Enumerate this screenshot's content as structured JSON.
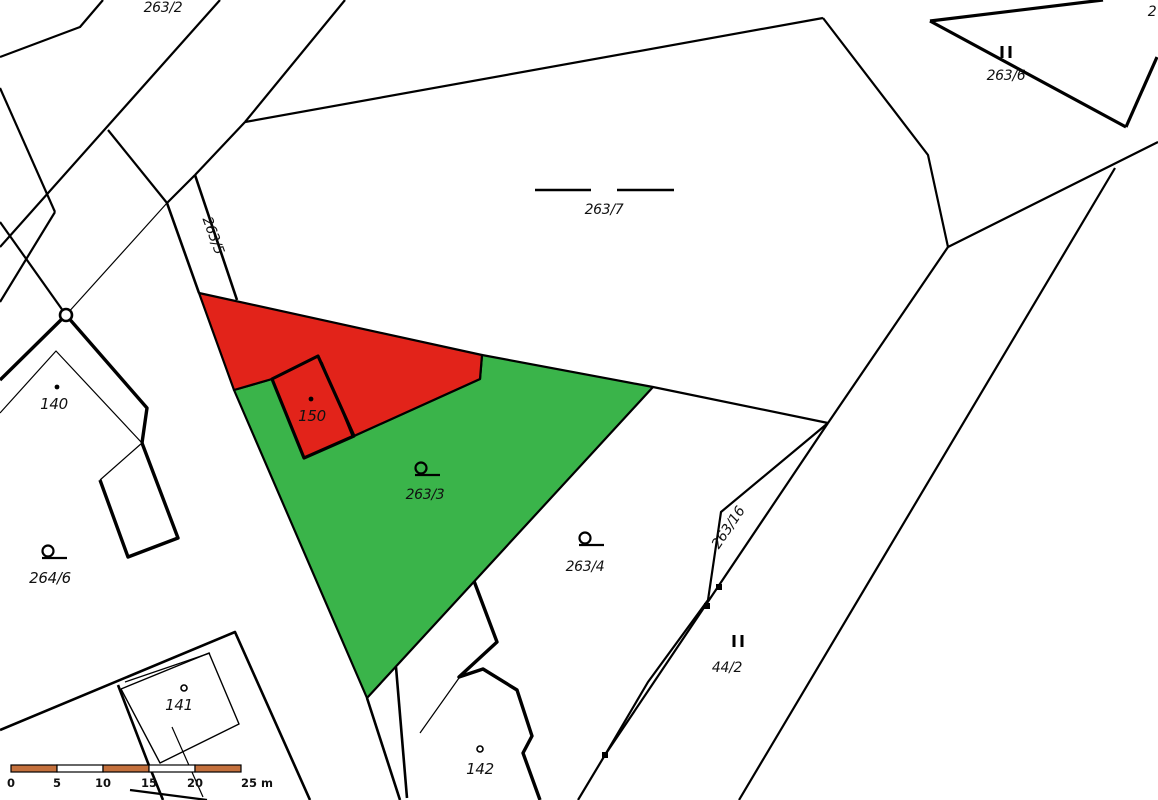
{
  "map": {
    "title": "cadastral-parcel-map",
    "colors": {
      "background": "#ffffff",
      "boundary": "#000000",
      "red_parcel_fill": "#e2231a",
      "green_parcel_fill": "#3ab44a",
      "grey_label": "#8f8f8f",
      "scale_orange": "#c4703c",
      "scale_white": "#ffffff"
    },
    "polygons": [
      {
        "name": "parcel-263-3-green-highlight",
        "fill": "green_parcel_fill",
        "interactable": true,
        "points": [
          [
            482,
            355
          ],
          [
            653,
            387
          ],
          [
            367,
            698
          ],
          [
            234,
            390
          ],
          [
            272,
            379
          ],
          [
            304,
            458
          ],
          [
            354,
            436
          ],
          [
            480,
            379
          ]
        ]
      },
      {
        "name": "parcel-red-highlight",
        "fill": "red_parcel_fill",
        "interactable": true,
        "points": [
          [
            199,
            293
          ],
          [
            482,
            355
          ],
          [
            480,
            379
          ],
          [
            354,
            436
          ],
          [
            304,
            458
          ],
          [
            272,
            379
          ],
          [
            234,
            390
          ]
        ]
      },
      {
        "name": "building-150-outline",
        "fill": "red_parcel_fill",
        "stroke_w": 3.2,
        "interactable": false,
        "points": [
          [
            272,
            379
          ],
          [
            318,
            356
          ],
          [
            354,
            436
          ],
          [
            304,
            458
          ]
        ]
      }
    ],
    "lines": [
      {
        "name": "boundary-line",
        "w": 2.2,
        "pts": [
          [
            103,
            0
          ],
          [
            80,
            27
          ],
          [
            0,
            57
          ]
        ]
      },
      {
        "name": "boundary-line",
        "w": 2.2,
        "pts": [
          [
            220,
            0
          ],
          [
            0,
            247
          ]
        ]
      },
      {
        "name": "boundary-line",
        "w": 2.2,
        "pts": [
          [
            108,
            130
          ],
          [
            167,
            203
          ]
        ]
      },
      {
        "name": "survey-line-thin",
        "w": 1.2,
        "pts": [
          [
            167,
            203
          ],
          [
            66,
            315
          ]
        ]
      },
      {
        "name": "road-263-5-left-edge",
        "w": 2.6,
        "pts": [
          [
            167,
            203
          ],
          [
            199,
            293
          ]
        ]
      },
      {
        "name": "road-263-5-right-edge",
        "w": 2.6,
        "pts": [
          [
            195,
            175
          ],
          [
            237,
            300
          ]
        ]
      },
      {
        "name": "boundary-line",
        "w": 2.2,
        "pts": [
          [
            195,
            175
          ],
          [
            167,
            203
          ]
        ]
      },
      {
        "name": "boundary-line",
        "w": 2.2,
        "pts": [
          [
            245,
            122
          ],
          [
            195,
            175
          ]
        ]
      },
      {
        "name": "boundary-line",
        "w": 2.2,
        "pts": [
          [
            245,
            122
          ],
          [
            345,
            0
          ]
        ]
      },
      {
        "name": "parcel-263-7-top-boundary",
        "w": 2.2,
        "pts": [
          [
            245,
            122
          ],
          [
            823,
            18
          ]
        ]
      },
      {
        "name": "parcel-263-7-right-boundary",
        "w": 2.2,
        "pts": [
          [
            823,
            18
          ],
          [
            928,
            155
          ],
          [
            948,
            247
          ]
        ]
      },
      {
        "name": "boundary-line",
        "w": 2.2,
        "pts": [
          [
            948,
            247
          ],
          [
            1158,
            142
          ]
        ]
      },
      {
        "name": "boundary-line-long-right",
        "w": 2.2,
        "pts": [
          [
            1115,
            168
          ],
          [
            739,
            800
          ]
        ]
      },
      {
        "name": "boundary-line",
        "w": 2.2,
        "pts": [
          [
            948,
            247
          ],
          [
            828,
            423
          ]
        ]
      },
      {
        "name": "boundary-line",
        "w": 2.2,
        "pts": [
          [
            653,
            387
          ],
          [
            828,
            423
          ]
        ]
      },
      {
        "name": "strip-263-16-left-edge",
        "w": 2.2,
        "pts": [
          [
            828,
            423
          ],
          [
            721,
            512
          ],
          [
            708,
            600
          ],
          [
            648,
            682
          ],
          [
            605,
            755
          ]
        ]
      },
      {
        "name": "strip-263-16-right-edge",
        "w": 2.2,
        "pts": [
          [
            828,
            423
          ],
          [
            605,
            755
          ]
        ]
      },
      {
        "name": "boundary-line",
        "w": 2.2,
        "pts": [
          [
            605,
            755
          ],
          [
            578,
            800
          ]
        ]
      },
      {
        "name": "boundary-line",
        "w": 2.2,
        "pts": [
          [
            0,
            88
          ],
          [
            55,
            212
          ]
        ]
      },
      {
        "name": "boundary-line",
        "w": 2.2,
        "pts": [
          [
            55,
            212
          ],
          [
            0,
            302
          ]
        ]
      },
      {
        "name": "boundary-line",
        "w": 2.2,
        "pts": [
          [
            0,
            222
          ],
          [
            66,
            315
          ]
        ]
      },
      {
        "name": "building-140-outer-wall",
        "w": 3.4,
        "pts": [
          [
            0,
            380
          ],
          [
            66,
            315
          ],
          [
            147,
            408
          ],
          [
            142,
            443
          ]
        ]
      },
      {
        "name": "building-140-lower-wall",
        "w": 3.4,
        "pts": [
          [
            142,
            443
          ],
          [
            178,
            538
          ],
          [
            128,
            557
          ],
          [
            100,
            480
          ]
        ]
      },
      {
        "name": "building-140-inner-line",
        "w": 1.2,
        "pts": [
          [
            100,
            480
          ],
          [
            142,
            443
          ]
        ]
      },
      {
        "name": "building-140-inner-wall",
        "w": 1.2,
        "pts": [
          [
            0,
            413
          ],
          [
            56,
            351
          ],
          [
            142,
            443
          ]
        ]
      },
      {
        "name": "road-edge",
        "w": 2.6,
        "pts": [
          [
            0,
            730
          ],
          [
            235,
            632
          ],
          [
            310,
            800
          ]
        ]
      },
      {
        "name": "road-edge",
        "w": 2.6,
        "pts": [
          [
            118,
            685
          ],
          [
            148,
            763
          ],
          [
            163,
            800
          ]
        ]
      },
      {
        "name": "parcel-line-thin",
        "w": 1.2,
        "pts": [
          [
            125,
            682
          ],
          [
            210,
            653
          ]
        ]
      },
      {
        "name": "building-141-outline",
        "w": 1.4,
        "pts": [
          [
            121,
            689
          ],
          [
            209,
            653
          ],
          [
            239,
            724
          ],
          [
            160,
            763
          ],
          [
            121,
            689
          ]
        ]
      },
      {
        "name": "parcel-line-thin",
        "w": 1.2,
        "pts": [
          [
            172,
            727
          ],
          [
            203,
            797
          ]
        ]
      },
      {
        "name": "boundary-line",
        "w": 2.2,
        "pts": [
          [
            130,
            790
          ],
          [
            207,
            800
          ]
        ]
      },
      {
        "name": "road-edge",
        "w": 2.6,
        "pts": [
          [
            367,
            698
          ],
          [
            400,
            800
          ]
        ]
      },
      {
        "name": "road-edge",
        "w": 2.6,
        "pts": [
          [
            396,
            667
          ],
          [
            407,
            798
          ]
        ]
      },
      {
        "name": "parcel-line-thin",
        "w": 1.2,
        "pts": [
          [
            420,
            733
          ],
          [
            459,
            678
          ]
        ]
      },
      {
        "name": "building-142-outline",
        "w": 3.4,
        "pts": [
          [
            474,
            581
          ],
          [
            497,
            642
          ],
          [
            459,
            677
          ],
          [
            483,
            669
          ],
          [
            517,
            690
          ],
          [
            532,
            736
          ],
          [
            523,
            753
          ],
          [
            540,
            800
          ]
        ]
      },
      {
        "name": "building-topright-wall",
        "w": 3.2,
        "pts": [
          [
            930,
            21
          ],
          [
            1103,
            0
          ]
        ]
      },
      {
        "name": "building-topright-wall",
        "w": 3.2,
        "pts": [
          [
            930,
            21
          ],
          [
            1126,
            127
          ]
        ]
      },
      {
        "name": "building-topright-wall",
        "w": 3.2,
        "pts": [
          [
            1126,
            127
          ],
          [
            1157,
            57
          ]
        ]
      },
      {
        "name": "building-150-inner-line",
        "w": 1.2,
        "pts": [
          [
            322,
            362
          ],
          [
            352,
            436
          ]
        ]
      },
      {
        "name": "landuse-dash-263-7",
        "w": 2.6,
        "pts": [
          [
            535,
            190
          ],
          [
            591,
            190
          ]
        ]
      },
      {
        "name": "landuse-dash-263-7",
        "w": 2.6,
        "pts": [
          [
            617,
            190
          ],
          [
            674,
            190
          ]
        ]
      }
    ],
    "labels": [
      {
        "name": "parcel-label-263-2",
        "text": "263/2",
        "x": 163,
        "y": 12,
        "size": 14
      },
      {
        "name": "parcel-label-263-5",
        "text": "263/5",
        "x": 209,
        "y": 237,
        "size": 14,
        "rotate": 70
      },
      {
        "name": "parcel-label-263-7",
        "text": "263/7",
        "x": 604,
        "y": 214,
        "size": 14
      },
      {
        "name": "parcel-label-263-6",
        "text": "263/6",
        "x": 1006,
        "y": 80,
        "size": 14
      },
      {
        "name": "parcel-label-partial-2",
        "text": "2",
        "x": 1152,
        "y": 16,
        "size": 14
      },
      {
        "name": "building-label-150",
        "text": "150",
        "x": 312,
        "y": 421,
        "size": 15
      },
      {
        "name": "parcel-label-263-3",
        "text": "263/3",
        "x": 425,
        "y": 499,
        "size": 14
      },
      {
        "name": "parcel-label-263-4",
        "text": "263/4",
        "x": 585,
        "y": 571,
        "size": 14
      },
      {
        "name": "parcel-label-263-16",
        "text": "263/16",
        "x": 732,
        "y": 530,
        "size": 14,
        "rotate": -56
      },
      {
        "name": "parcel-label-44-2",
        "text": "44/2",
        "x": 727,
        "y": 672,
        "size": 14,
        "color": "grey_label"
      },
      {
        "name": "parcel-label-264-6",
        "text": "264/6",
        "x": 50,
        "y": 583,
        "size": 15
      },
      {
        "name": "building-label-140",
        "text": "140",
        "x": 54,
        "y": 409,
        "size": 15
      },
      {
        "name": "building-label-141",
        "text": "141",
        "x": 179,
        "y": 710,
        "size": 15
      },
      {
        "name": "building-label-142",
        "text": "142",
        "x": 480,
        "y": 774,
        "size": 15
      }
    ],
    "symbols": {
      "garden": [
        {
          "name": "garden-symbol-263-3",
          "x": 421,
          "y": 468
        },
        {
          "name": "garden-symbol-264-6",
          "x": 48,
          "y": 551
        },
        {
          "name": "garden-symbol-263-4",
          "x": 585,
          "y": 538
        }
      ],
      "grassland": [
        {
          "name": "grassland-symbol-263-6",
          "x": 1006,
          "y": 52
        },
        {
          "name": "grassland-symbol-44-2",
          "x": 738,
          "y": 641
        }
      ],
      "point_markers": [
        [
          719,
          587
        ],
        [
          707,
          606
        ],
        [
          605,
          755
        ]
      ],
      "solid_dots": [
        [
          57,
          387
        ],
        [
          311,
          399
        ]
      ],
      "ring_dots": [
        [
          184,
          688
        ],
        [
          480,
          749
        ]
      ],
      "circle_markers": [
        [
          66,
          315
        ]
      ]
    },
    "scalebar": {
      "x": 11,
      "y": 765,
      "segment_width": 46,
      "height": 7,
      "segment_colors": [
        "scale_orange",
        "scale_white",
        "scale_orange",
        "scale_white",
        "scale_orange"
      ],
      "tick_labels": [
        "0",
        "5",
        "10",
        "15",
        "20",
        "25 m"
      ],
      "label_baseline_y": 787
    }
  }
}
